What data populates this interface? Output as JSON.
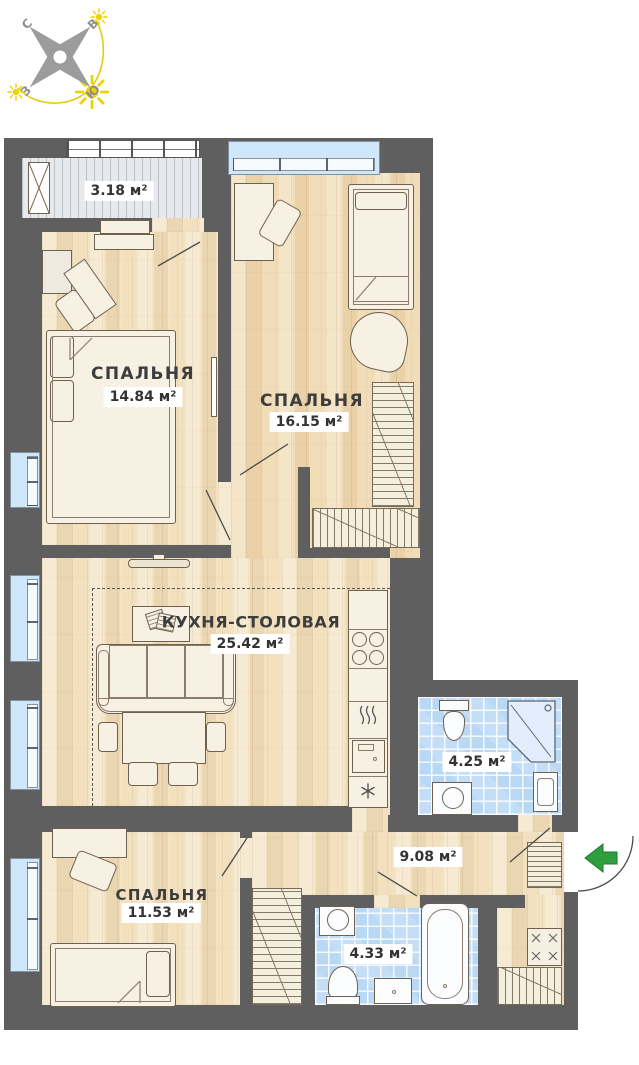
{
  "title": "Floor plan of a 3-bedroom apartment",
  "compass": {
    "north": "С",
    "east": "В",
    "west": "З",
    "south": "Ю"
  },
  "rooms": [
    {
      "id": "balcony",
      "name": "",
      "area": "3.18 м²"
    },
    {
      "id": "bedroom-1",
      "name": "СПАЛЬНЯ",
      "area": "14.84 м²"
    },
    {
      "id": "bedroom-2",
      "name": "СПАЛЬНЯ",
      "area": "16.15 м²"
    },
    {
      "id": "kitchen-dining",
      "name": "КУХНЯ-СТОЛОВАЯ",
      "area": "25.42 м²"
    },
    {
      "id": "bathroom-1",
      "name": "",
      "area": "4.25 м²"
    },
    {
      "id": "hallway",
      "name": "",
      "area": "9.08 м²"
    },
    {
      "id": "bedroom-3",
      "name": "СПАЛЬНЯ",
      "area": "11.53 м²"
    },
    {
      "id": "bathroom-2",
      "name": "",
      "area": "4.33 м²"
    }
  ],
  "colors": {
    "wall": "#5f5f5f",
    "wood_floor": "#f3e3c3",
    "tile_floor": "#b9d8f4",
    "window": "#cfe7fb",
    "balcony_floor": "#e7e9ec",
    "entry_arrow": "#2f9e3e",
    "sun": "#eed202"
  }
}
